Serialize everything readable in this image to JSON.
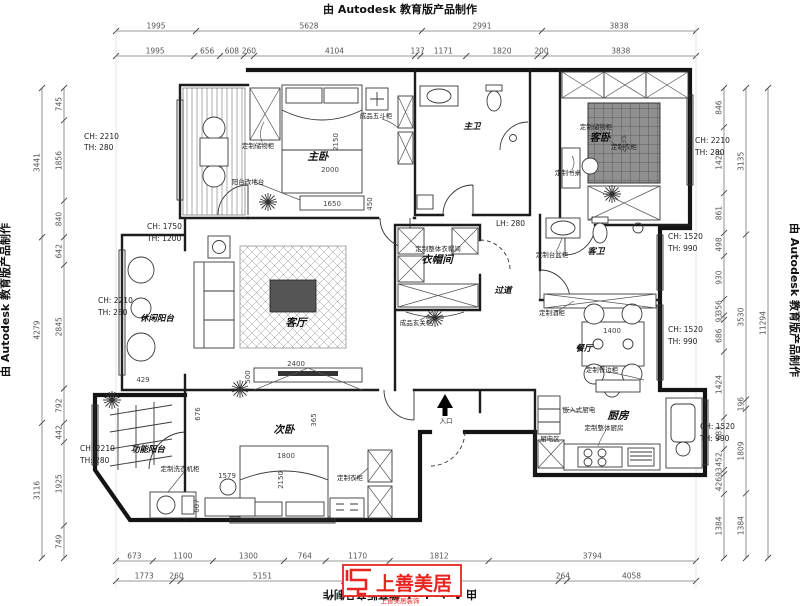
{
  "watermark": {
    "text": "由 Autodesk 教育版产品制作"
  },
  "logo": {
    "brand": "上善美居",
    "tagline": "上善美居装饰",
    "color": "#e8251f"
  },
  "dims": {
    "top_outer": [
      "1995",
      "5628",
      "2991",
      "3838"
    ],
    "top_inner": [
      "1995",
      "656",
      "608",
      "260",
      "4104",
      "137",
      "1171",
      "1820",
      "200",
      "3838"
    ],
    "left_outer": [
      "3441",
      "4279",
      "3116"
    ],
    "left_inner": [
      "745",
      "1856",
      "840",
      "642",
      "2845",
      "792",
      "442",
      "1925",
      "749"
    ],
    "right_inner": [
      "846",
      "1428",
      "861",
      "498",
      "930",
      "356",
      "93",
      "686",
      "1424",
      "683",
      "452",
      "93",
      "426",
      "1384"
    ],
    "right_mid": [
      "3135",
      "3530",
      "196",
      "1809",
      "1384"
    ],
    "right_outer": [
      "11294"
    ],
    "bottom_inner": [
      "673",
      "1100",
      "1300",
      "764",
      "1170",
      "1812",
      "3794"
    ],
    "bottom_outer": [
      "1773",
      "260",
      "5151",
      "6746",
      "264",
      "4058"
    ]
  },
  "rooms": {
    "master": "主卧",
    "master_bath": "主卫",
    "guest": "客卧",
    "cloak": "衣帽间",
    "hall": "过道",
    "guest_bath": "客卫",
    "living": "客厅",
    "dining": "餐厅",
    "kitchen": "厨房",
    "second": "次卧",
    "leisure_balcony": "休闲阳台",
    "func_balcony": "功能阳台",
    "entry": "入口",
    "appliance_zone": "厨电区"
  },
  "annotations": {
    "lh280": "LH: 280",
    "ch2210": "CH: 2210",
    "th280": "TH: 280",
    "ch1750": "CH: 1750",
    "th1200": "TH: 1200",
    "ch1520": "CH: 1520",
    "th990": "TH: 990"
  },
  "furniture_labels": {
    "storage_master": "定制储物柜",
    "platform": "阳台改地台",
    "chest": "成品五斗柜",
    "storage_guest": "定制储物柜",
    "wardrobe_guest": "定制衣柜",
    "desk_guest": "定制书桌",
    "cloak_custom": "定制整体衣帽间",
    "entry_cabinet": "成品玄关柜",
    "basin_cabinet": "定制台盆柜",
    "wine_cabinet": "定制酒柜",
    "sideboard": "定制餐边柜",
    "builtin_appliance": "嵌入式厨电",
    "kitchen_custom": "定制整体厨房",
    "laundry_cabinet": "定制洗衣机柜",
    "wardrobe_second": "定制衣柜"
  },
  "inplan_dims": {
    "m_bed_w": "2150",
    "m_bed_l": "2000",
    "m_dresser": "1650",
    "m_450": "450",
    "g_tatami": "2135",
    "l_tv": "2400",
    "l_500": "500",
    "l_429": "429",
    "s_676": "676",
    "s_desk": "1579",
    "s_607": "607",
    "s_bed_w": "1800",
    "s_bed_l": "2150",
    "s_365": "365",
    "d_table": "1400"
  }
}
